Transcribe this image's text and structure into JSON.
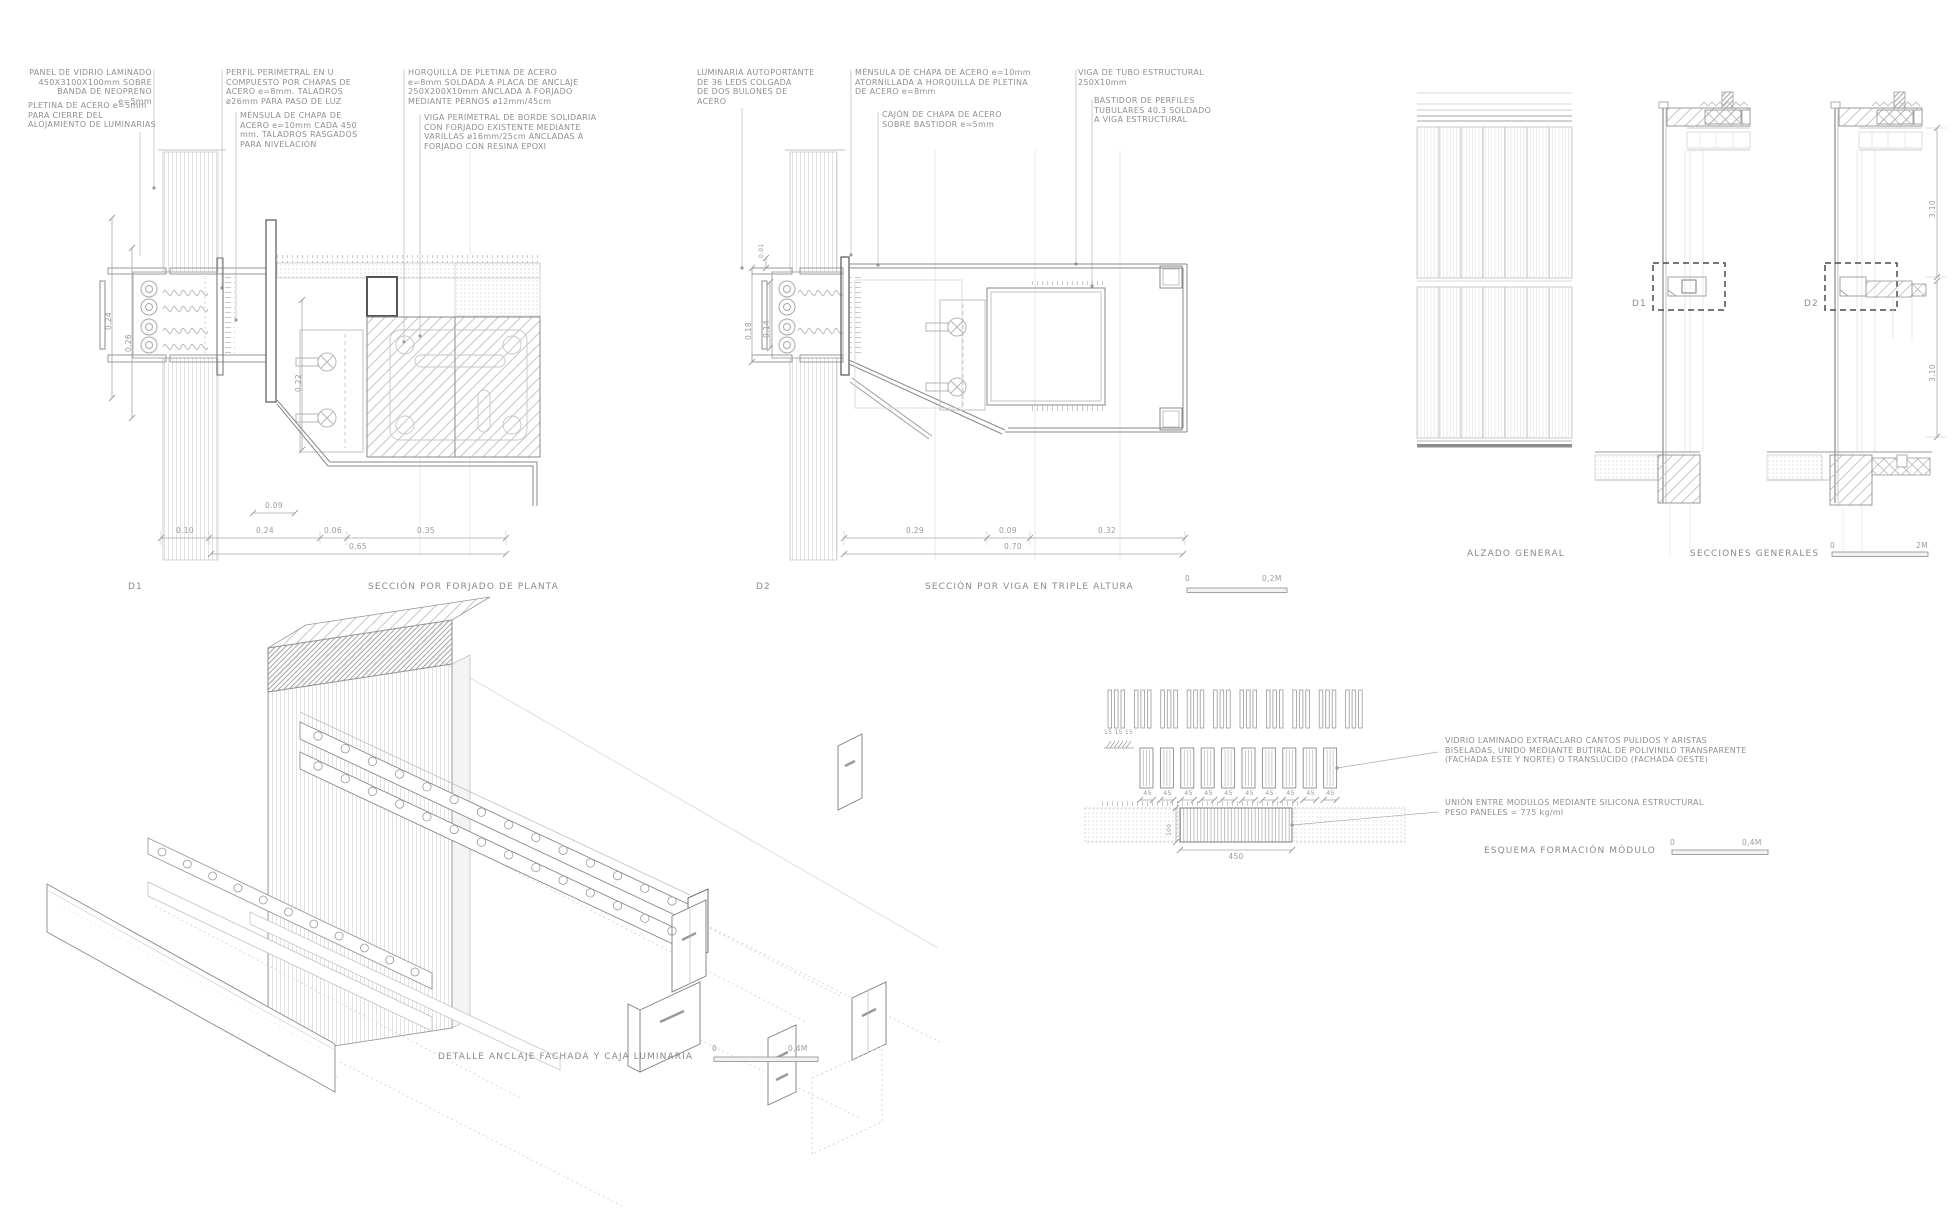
{
  "sheet": {
    "background": "#ffffff",
    "ink": "#8f8f8f",
    "line": "#9a9a9a"
  },
  "d1": {
    "label": "D1",
    "caption": "SECCIÓN POR FORJADO DE PLANTA",
    "annotations": {
      "panel": "PANEL DE VIDRIO LAMINADO\n450X3100X100mm SOBRE\nBANDA DE NEOPRENO e=5mm",
      "pletina": "PLETINA DE ACERO e=5mm\nPARA CIERRE DEL\nALOJAMIENTO DE LUMINARIAS",
      "perfil": "PERFIL PERIMETRAL EN U\nCOMPUESTO POR CHAPAS DE\nACERO e=8mm. TALADROS\nø26mm PARA PASO DE LUZ",
      "mensula": "MÉNSULA DE CHAPA DE\nACERO e=10mm CADA 450\nmm. TALADROS RASGADOS\nPARA NIVELACIÓN",
      "horquilla": "HORQUILLA DE PLETINA DE ACERO\ne=8mm SOLDADA A PLACA DE ANCLAJE\n250X200X10mm ANCLADA A FORJADO\nMEDIANTE PERNOS ø12mm/45cm",
      "viga_perimetral": "VIGA PERIMETRAL DE BORDE SOLIDARIA\nCON FORJADO EXISTENTE MEDIANTE\nVARILLAS ø16mm/25cm ANCLADAS A\nFORJADO CON RESINA EPOXI"
    },
    "dims": {
      "v1": "0.24",
      "v2": "0.26",
      "v3": "0.22",
      "small": "0.09",
      "row": [
        "0.10",
        "0.24",
        "0.06",
        "0.35"
      ],
      "total": "0.65"
    }
  },
  "d2": {
    "label": "D2",
    "caption": "SECCIÓN POR VIGA EN TRIPLE ALTURA",
    "scale": {
      "zero": "0",
      "max": "0,2M"
    },
    "annotations": {
      "luminaria": "LUMINARIA AUTOPORTANTE\nDE 36 LEDS COLGADA\nDE DOS BULONES DE\nACERO",
      "mensula": "MÉNSULA DE CHAPA DE ACERO e=10mm\nATORNILLADA A HORQUILLA DE PLETINA\nDE ACERO e=8mm",
      "cajon": "CAJÓN DE CHAPA DE ACERO\nSOBRE BASTIDOR e=5mm",
      "viga_tubo": "VIGA DE TUBO ESTRUCTURAL\n250X10mm",
      "bastidor": "BASTIDOR DE PERFILES\nTUBULARES 40.3 SOLDADO\nA VIGA ESTRUCTURAL"
    },
    "dims": {
      "gap": "0.01",
      "v1": "0.18",
      "v2": "0.14",
      "row": [
        "0.29",
        "0.09",
        "0.32"
      ],
      "total": "0.70"
    }
  },
  "sections": {
    "alzado_caption": "ALZADO GENERAL",
    "secciones_caption": "SECCIONES GENERALES",
    "scale": {
      "zero": "0",
      "max": "2M"
    },
    "d1_label": "D1",
    "d2_label": "D2",
    "dim_upper": "3.10",
    "dim_lower": "3.10"
  },
  "axon": {
    "caption": "DETALLE ANCLAJE FACHADA Y CAJA LUMINARIA",
    "scale": {
      "zero": "0",
      "max": "0,4M"
    }
  },
  "module_schema": {
    "caption": "ESQUEMA FORMACIÓN MÓDULO",
    "scale": {
      "zero": "0",
      "max": "0,4M"
    },
    "glass_note": "VIDRIO LAMINADO EXTRACLARO CANTOS PULIDOS Y ARISTAS\nBISELADAS, UNIDO MEDIANTE BUTIRAL DE POLIVINILO TRANSPARENTE\n(FACHADA ESTE Y NORTE) O TRANSLÚCIDO (FACHADA OESTE)",
    "union_note": "UNIÓN ENTRE MODULOS MEDIANTE SILICONA ESTRUCTURAL\nPESO PANELES = 775 kg/ml",
    "triple_dim": "15 15 15",
    "bar_dim": "45",
    "height_dim": "100",
    "module_width": "450"
  }
}
